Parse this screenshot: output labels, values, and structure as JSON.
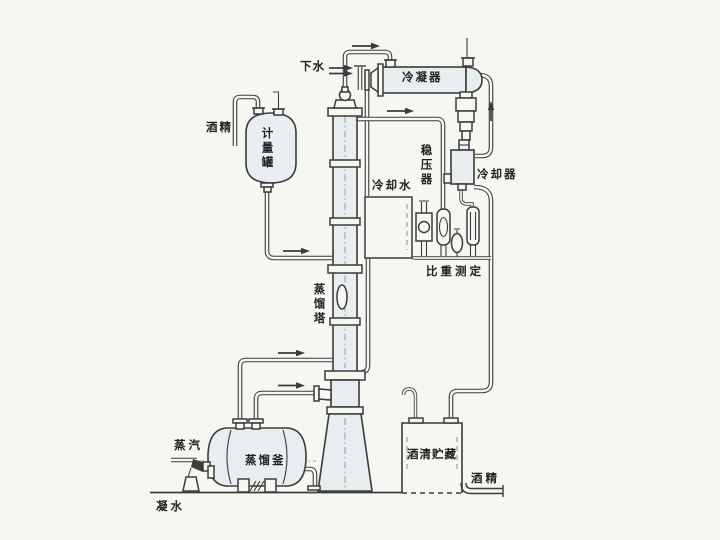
{
  "diagram": {
    "labels": {
      "drain_water": "下水",
      "condenser": "冷凝器",
      "alcohol_in": "酒精",
      "measuring_tank": "计量罐",
      "pressure_stabilizer": "稳压器",
      "cooling_water": "冷却水",
      "cooler": "冷却器",
      "gravity_measurement": "比重测定",
      "distillation_column": "蒸馏塔",
      "steam": "蒸汽",
      "distillation_kettle": "蒸馏釜",
      "alcohol_storage": "酒清贮藏",
      "alcohol_out": "酒精",
      "condensate_water": "凝水"
    },
    "colors": {
      "paper": "#f6f6f3",
      "line": "#3b3b3b",
      "vessel_fill": "#e8edef",
      "text": "#222222"
    }
  }
}
